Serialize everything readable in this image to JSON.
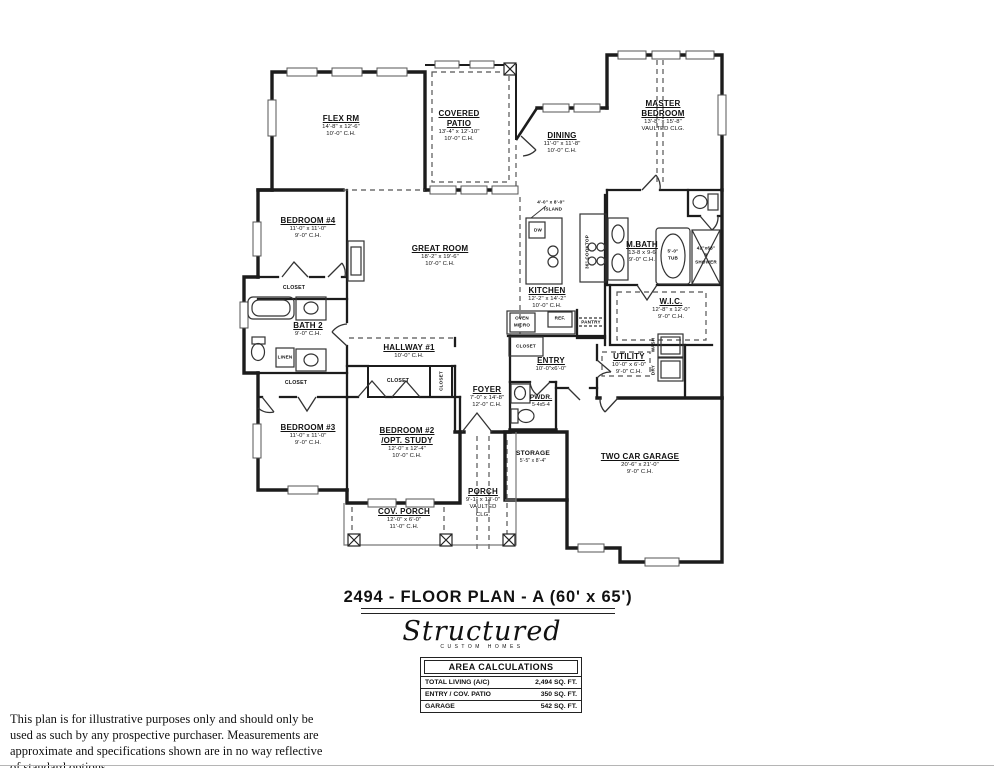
{
  "title": "2494 - FLOOR  PLAN - A  (60' x 65')",
  "logo": {
    "script": "Structured",
    "subtitle": "CUSTOM HOMES"
  },
  "area_calculations": {
    "header": "AREA CALCULATIONS",
    "rows": [
      {
        "label": "TOTAL LIVING (A/C)",
        "value": "2,494 SQ. FT."
      },
      {
        "label": "ENTRY / COV. PATIO",
        "value": "350 SQ. FT."
      },
      {
        "label": "GARAGE",
        "value": "542 SQ. FT."
      }
    ]
  },
  "disclaimer": "This plan is for illustrative purposes only and should only be used as such by any prospective purchaser. Measurements are approximate and specifications shown are in no way reflective of standard options.",
  "rooms": {
    "flex": {
      "name": "FLEX RM",
      "dims": "14'-8\" x 12'-6\"",
      "ch": "10'-0\" C.H."
    },
    "covered_patio": {
      "name1": "COVERED",
      "name2": "PATIO",
      "dims": "13'-4\" x 12'-10\"",
      "ch": "10'-0\" C.H."
    },
    "dining": {
      "name": "DINING",
      "dims": "11'-0\" x 11'-8\"",
      "ch": "10'-0\" C.H."
    },
    "master": {
      "name1": "MASTER",
      "name2": "BEDROOM",
      "dims": "13'-8\" x 15'-8\"",
      "ch": "VAULTED CLG."
    },
    "bedroom4": {
      "name": "BEDROOM #4",
      "dims": "11'-0\" x 11'-0\"",
      "ch": "9'-0\" C.H."
    },
    "great": {
      "name": "GREAT ROOM",
      "dims": "18'-2\" x 19'-6\"",
      "ch": "10'-0\" C.H."
    },
    "kitchen": {
      "name": "KITCHEN",
      "dims": "12'-2\" x 14'-2\"",
      "ch": "10'-0\" C.H."
    },
    "mbath": {
      "name": "M.BATH",
      "dims": "13-8 x 9-6",
      "ch": "9'-0\" C.H."
    },
    "wic": {
      "name": "W.I.C.",
      "dims": "12'-8\" x 12'-0\"",
      "ch": "9'-0\" C.H."
    },
    "bath2": {
      "name": "BATH 2",
      "ch": "9'-0\" C.H."
    },
    "hallway1": {
      "name": "HALLWAY #1",
      "ch": "10'-0\" C.H."
    },
    "entry": {
      "name": "ENTRY",
      "dims": "10'-0\"x6'-0\""
    },
    "utility": {
      "name": "UTILITY",
      "dims": "10'-0\" x 6'-0\"",
      "ch": "9'-0\" C.H."
    },
    "foyer": {
      "name": "FOYER",
      "dims": "7'-0\" x 14'-8\"",
      "ch": "12'-0\" C.H."
    },
    "pwdr": {
      "name": "PWDR.",
      "dims": "5-4x5-4"
    },
    "bedroom3": {
      "name": "BEDROOM #3",
      "dims": "11'-0\" x 11'-0\"",
      "ch": "9'-0\" C.H."
    },
    "bedroom2": {
      "name1": "BEDROOM #2",
      "name2": "/OPT. STUDY",
      "dims": "12'-0\" x 12'-4\"",
      "ch": "10'-0\" C.H."
    },
    "storage": {
      "name": "STORAGE",
      "dims": "5'-5\" x 8'-4\""
    },
    "garage": {
      "name": "TWO CAR GARAGE",
      "dims": "20'-6\" x 21'-0\"",
      "ch": "9'-0\" C.H."
    },
    "porch": {
      "name": "PORCH",
      "dims": "9'-1\" x 13'-0\"",
      "ch1": "VAULTED",
      "ch2": "CLG."
    },
    "cov_porch": {
      "name": "COV. PORCH",
      "dims": "12'-0\" x 6'-0\"",
      "ch": "11'-0\" C.H."
    }
  },
  "labels": {
    "closet": "CLOSET",
    "linen": "LINEN",
    "pantry": "PANTRY",
    "ref": "REF.",
    "oven": "OVEN",
    "micro": "MICRO",
    "dw": "DW",
    "island_dims": "4'-0\" x 8'-0\"",
    "island": "ISLAND",
    "cooktop": "36\" COOKTOP",
    "tub_size": "5'-0\"",
    "tub": "TUB",
    "shower_size": "42\"x68\"",
    "shower_r": "R",
    "shower": "SHOWER",
    "wash": "WASH",
    "dry": "DRY"
  },
  "colors": {
    "wall": "#1c1c1c",
    "line": "#444444",
    "text": "#111111",
    "paper": "#ffffff"
  }
}
